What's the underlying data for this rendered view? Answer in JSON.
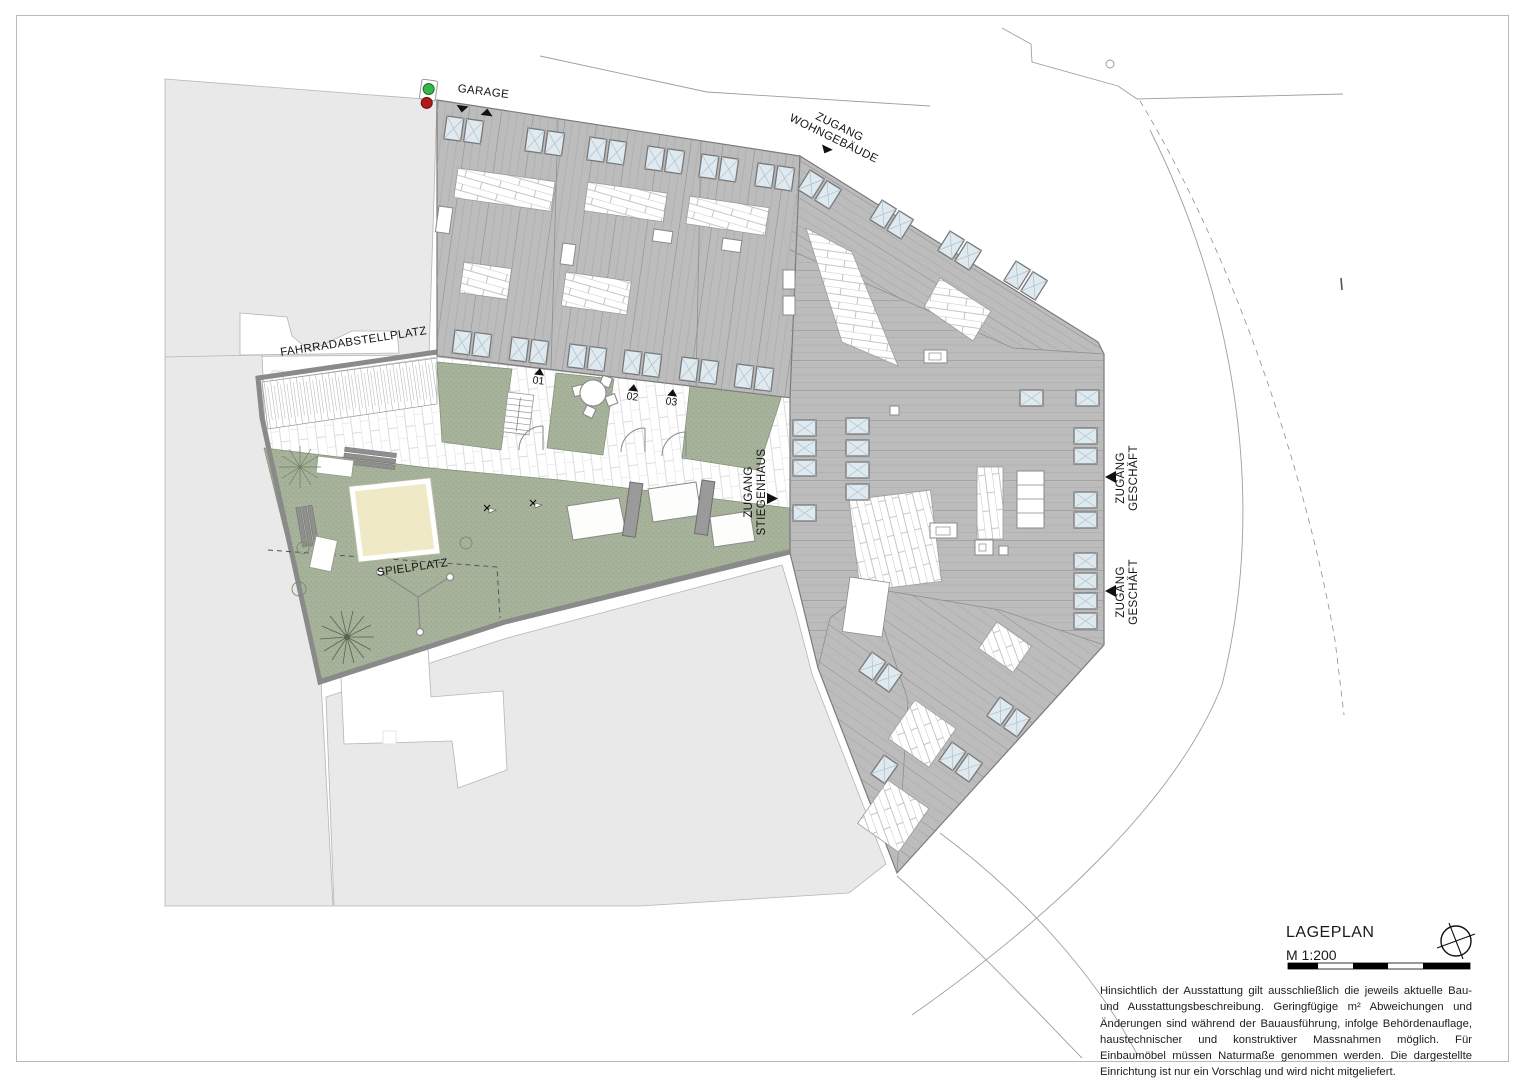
{
  "plan": {
    "labels": {
      "garage": "GARAGE",
      "zugang_wohngebaeude_1": "ZUGANG",
      "zugang_wohngebaeude_2": "WOHNGEBÄUDE",
      "fahrradabstellplatz": "FAHRRADABSTELLPLATZ",
      "spielplatz": "SPIELPLATZ",
      "zugang_stiegenhaus_1": "ZUGANG",
      "zugang_stiegenhaus_2": "STIEGENHAUS",
      "zugang_geschaeft_1": "ZUGANG",
      "zugang_geschaeft_2": "GESCHÄFT",
      "entrance_01": "01",
      "entrance_02": "02",
      "entrance_03": "03"
    },
    "titleblock": {
      "title": "LAGEPLAN",
      "scale": "M 1:200",
      "disclaimer": "Hinsichtlich der Ausstattung gilt ausschließlich die jeweils aktuelle Bau- und Ausstattungsbeschreibung. Geringfügige m² Abweichungen und Änderungen sind während der Bauausführung, infolge Behördenauflage, haustechnischer und konstruktiver Massnahmen möglich. Für Einbaumöbel müssen Naturmaße genommen werden. Die dargestellte Einrichtung ist nur ein Vorschlag und wird nicht mitgeliefert."
    },
    "colors": {
      "roof_fill": "#bcbcbc",
      "parcel_fill": "#e9e9e9",
      "lawn_fill": "#a6b29a",
      "sand_fill": "#efe9c6",
      "wall": "#8a8a8a",
      "skylight_fill": "#dfe9f0",
      "signal_green": "#39b54a",
      "signal_red": "#b01a1a"
    }
  }
}
